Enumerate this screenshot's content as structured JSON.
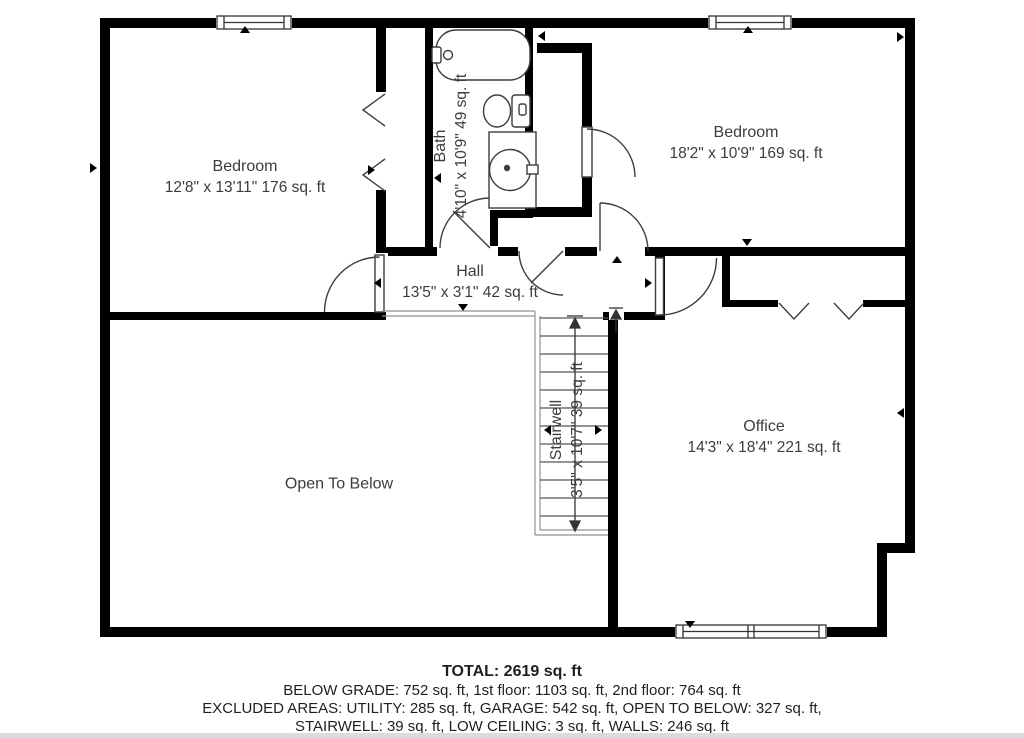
{
  "plan": {
    "floor": "2nd floor",
    "rooms": [
      {
        "id": "bedroom-1",
        "name": "Bedroom",
        "dims": "12'8\" x 13'11\" 176 sq. ft"
      },
      {
        "id": "bath",
        "name": "Bath",
        "dims": "4'10\" x 10'9\" 49 sq. ft"
      },
      {
        "id": "bedroom-2",
        "name": "Bedroom",
        "dims": "18'2\" x 10'9\" 169 sq. ft"
      },
      {
        "id": "hall",
        "name": "Hall",
        "dims": "13'5\" x 3'1\" 42 sq. ft"
      },
      {
        "id": "stairwell",
        "name": "Stairwell",
        "dims": "3'5\" x 10'7\" 39 sq. ft"
      },
      {
        "id": "office",
        "name": "Office",
        "dims": "14'3\" x 18'4\" 221 sq. ft"
      },
      {
        "id": "open-to-below",
        "name": "Open To Below",
        "dims": ""
      }
    ],
    "summary": {
      "total": "TOTAL: 2619 sq. ft",
      "line2": "BELOW GRADE: 752 sq. ft, 1st floor: 1103 sq. ft, 2nd floor: 764 sq. ft",
      "line3": "EXCLUDED AREAS: UTILITY: 285 sq. ft, GARAGE: 542 sq. ft, OPEN TO BELOW: 327 sq. ft,",
      "line4": "STAIRWELL: 39 sq. ft, LOW CEILING: 3 sq. ft, WALLS: 246 sq. ft"
    },
    "colors": {
      "wall": "#000000",
      "fixture_line": "#3d3d3d",
      "thin_line": "#919191",
      "text": "#3c3c3c",
      "background": "#ffffff"
    }
  }
}
